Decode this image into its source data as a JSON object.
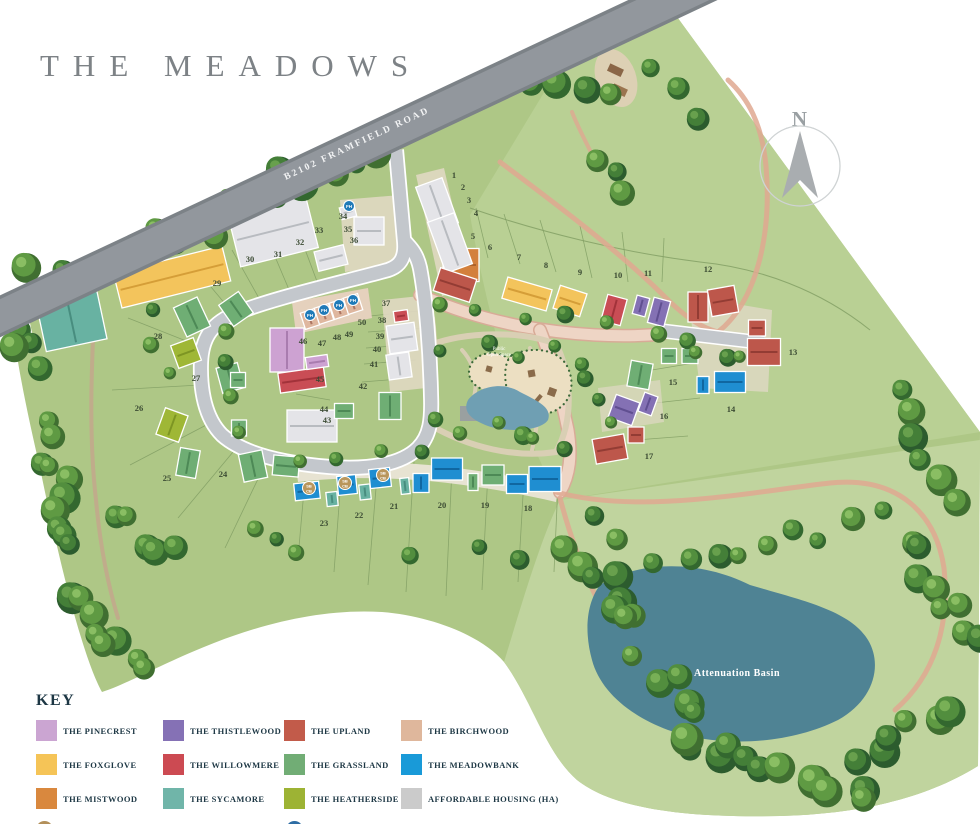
{
  "title": "THE MEADOWS",
  "road_label": "B2102 FRAMFIELD ROAD",
  "compass": {
    "label": "N"
  },
  "park_label": {
    "line1": "Public",
    "line2": "Open Space"
  },
  "basin_label": "Attenuation Basin",
  "key": {
    "heading": "KEY",
    "items": [
      {
        "name": "THE PINECREST",
        "slug": "pinecrest",
        "color": "#cba5d2"
      },
      {
        "name": "THE FOXGLOVE",
        "slug": "foxglove",
        "color": "#f5c457"
      },
      {
        "name": "THE MISTWOOD",
        "slug": "mistwood",
        "color": "#d9883e"
      },
      {
        "name": "THE THISTLEWOOD",
        "slug": "thistlewood",
        "color": "#8571b5"
      },
      {
        "name": "THE WILLOWMERE",
        "slug": "willowmere",
        "color": "#cc4a52"
      },
      {
        "name": "THE SYCAMORE",
        "slug": "sycamore",
        "color": "#70b5a9"
      },
      {
        "name": "THE UPLAND",
        "slug": "upland",
        "color": "#c25b4a"
      },
      {
        "name": "THE GRASSLAND",
        "slug": "grassland",
        "color": "#71ad75"
      },
      {
        "name": "THE HEATHERSIDE",
        "slug": "heatherside",
        "color": "#9db334"
      },
      {
        "name": "THE BIRCHWOOD",
        "slug": "birchwood",
        "color": "#dfb79c"
      },
      {
        "name": "THE MEADOWBANK",
        "slug": "meadowbank",
        "color": "#199ad8"
      },
      {
        "name": "AFFORDABLE HOUSING (HA)",
        "slug": "ha",
        "color": "#cbcbcb"
      }
    ],
    "notes": [
      {
        "badge_lines": [
          "SB",
          "CB"
        ],
        "badge_color": "#b3905a",
        "text": "PLOTS 21-23 ARE SELF-BUILD/CUSTOM-BUILD PLOTS"
      },
      {
        "badge_lines": [
          "FH"
        ],
        "badge_color": "#2e6da4",
        "text": "PLOTS 34, 47, 48, 49 & 50 ARE FIRST HOMES"
      }
    ]
  },
  "house_colors": {
    "pinecrest": {
      "fill": "#cda2d2",
      "dark": "#a678ac"
    },
    "foxglove": {
      "fill": "#f3c45c",
      "dark": "#d29a35"
    },
    "mistwood": {
      "fill": "#d3803c",
      "dark": "#a95f28"
    },
    "thistlewood": {
      "fill": "#8471b4",
      "dark": "#5d4c8e"
    },
    "willowmere": {
      "fill": "#c94d55",
      "dark": "#9e3038"
    },
    "sycamore": {
      "fill": "#68b2a2",
      "dark": "#458a7c"
    },
    "upland": {
      "fill": "#bd574b",
      "dark": "#8f3a32"
    },
    "grassland": {
      "fill": "#6fae74",
      "dark": "#4a8553"
    },
    "heatherside": {
      "fill": "#9fb736",
      "dark": "#7a9222"
    },
    "birchwood": {
      "fill": "#dfb79f",
      "dark": "#a9705c"
    },
    "meadowbank": {
      "fill": "#1f8ed1",
      "dark": "#0f639c"
    },
    "ha": {
      "fill": "#e4e4e8",
      "dark": "#b4b7bc"
    }
  },
  "plots": [
    {
      "n": "1",
      "x": 454,
      "y": 178
    },
    {
      "n": "2",
      "x": 463,
      "y": 190
    },
    {
      "n": "3",
      "x": 469,
      "y": 203
    },
    {
      "n": "4",
      "x": 476,
      "y": 216
    },
    {
      "n": "5",
      "x": 473,
      "y": 239
    },
    {
      "n": "6",
      "x": 490,
      "y": 250
    },
    {
      "n": "7",
      "x": 519,
      "y": 260
    },
    {
      "n": "8",
      "x": 546,
      "y": 268
    },
    {
      "n": "9",
      "x": 580,
      "y": 275
    },
    {
      "n": "10",
      "x": 618,
      "y": 278
    },
    {
      "n": "11",
      "x": 648,
      "y": 276
    },
    {
      "n": "12",
      "x": 708,
      "y": 272
    },
    {
      "n": "13",
      "x": 793,
      "y": 355
    },
    {
      "n": "14",
      "x": 731,
      "y": 412
    },
    {
      "n": "15",
      "x": 673,
      "y": 385
    },
    {
      "n": "16",
      "x": 664,
      "y": 419
    },
    {
      "n": "17",
      "x": 649,
      "y": 459
    },
    {
      "n": "18",
      "x": 528,
      "y": 511
    },
    {
      "n": "19",
      "x": 485,
      "y": 508
    },
    {
      "n": "20",
      "x": 442,
      "y": 508
    },
    {
      "n": "21",
      "x": 394,
      "y": 509
    },
    {
      "n": "22",
      "x": 359,
      "y": 518
    },
    {
      "n": "23",
      "x": 324,
      "y": 526
    },
    {
      "n": "24",
      "x": 223,
      "y": 477
    },
    {
      "n": "25",
      "x": 167,
      "y": 481
    },
    {
      "n": "26",
      "x": 139,
      "y": 411
    },
    {
      "n": "27",
      "x": 196,
      "y": 381
    },
    {
      "n": "28",
      "x": 158,
      "y": 339
    },
    {
      "n": "29",
      "x": 217,
      "y": 286
    },
    {
      "n": "30",
      "x": 250,
      "y": 262
    },
    {
      "n": "31",
      "x": 278,
      "y": 257
    },
    {
      "n": "32",
      "x": 300,
      "y": 245
    },
    {
      "n": "33",
      "x": 319,
      "y": 233
    },
    {
      "n": "34",
      "x": 343,
      "y": 219
    },
    {
      "n": "35",
      "x": 348,
      "y": 232
    },
    {
      "n": "36",
      "x": 354,
      "y": 243
    },
    {
      "n": "37",
      "x": 386,
      "y": 306
    },
    {
      "n": "38",
      "x": 382,
      "y": 323
    },
    {
      "n": "39",
      "x": 380,
      "y": 339
    },
    {
      "n": "40",
      "x": 377,
      "y": 352
    },
    {
      "n": "41",
      "x": 374,
      "y": 367
    },
    {
      "n": "42",
      "x": 363,
      "y": 389
    },
    {
      "n": "43",
      "x": 327,
      "y": 423
    },
    {
      "n": "44",
      "x": 324,
      "y": 412
    },
    {
      "n": "45",
      "x": 320,
      "y": 382
    },
    {
      "n": "46",
      "x": 303,
      "y": 344
    },
    {
      "n": "47",
      "x": 322,
      "y": 346
    },
    {
      "n": "48",
      "x": 337,
      "y": 340
    },
    {
      "n": "49",
      "x": 349,
      "y": 337
    },
    {
      "n": "50",
      "x": 362,
      "y": 325
    }
  ],
  "houses": [
    {
      "t": "sycamore",
      "x": 69,
      "y": 309,
      "w": 62,
      "h": 74,
      "r": -12
    },
    {
      "t": "sycamore",
      "x": 16,
      "y": 318,
      "w": 24,
      "h": 40,
      "r": -12
    },
    {
      "t": "foxglove",
      "x": 172,
      "y": 277,
      "w": 112,
      "h": 36,
      "r": -14
    },
    {
      "t": "ha",
      "x": 273,
      "y": 231,
      "w": 80,
      "h": 54,
      "r": -14
    },
    {
      "t": "ha",
      "x": 369,
      "y": 231,
      "w": 30,
      "h": 28,
      "r": 0
    },
    {
      "t": "ha",
      "x": 331,
      "y": 258,
      "w": 30,
      "h": 20,
      "r": -14
    },
    {
      "t": "ha",
      "x": 348,
      "y": 212,
      "w": 15,
      "h": 12,
      "r": -14
    },
    {
      "t": "pinecrest",
      "x": 287,
      "y": 350,
      "w": 34,
      "h": 44,
      "r": 0
    },
    {
      "t": "birchwood",
      "x": 310,
      "y": 319,
      "w": 15,
      "h": 17,
      "r": -18
    },
    {
      "t": "birchwood",
      "x": 324,
      "y": 314,
      "w": 15,
      "h": 17,
      "r": -18
    },
    {
      "t": "birchwood",
      "x": 339,
      "y": 309,
      "w": 15,
      "h": 17,
      "r": -18
    },
    {
      "t": "birchwood",
      "x": 353,
      "y": 304,
      "w": 15,
      "h": 17,
      "r": -18
    },
    {
      "t": "willowmere",
      "x": 302,
      "y": 380,
      "w": 46,
      "h": 20,
      "r": -8
    },
    {
      "t": "pinecrest",
      "x": 317,
      "y": 362,
      "w": 22,
      "h": 12,
      "r": -8
    },
    {
      "t": "ha",
      "x": 312,
      "y": 426,
      "w": 50,
      "h": 32,
      "r": 0
    },
    {
      "t": "grassland",
      "x": 192,
      "y": 317,
      "w": 26,
      "h": 32,
      "r": -25
    },
    {
      "t": "heatherside",
      "x": 186,
      "y": 353,
      "w": 24,
      "h": 24,
      "r": -20
    },
    {
      "t": "grassland",
      "x": 236,
      "y": 309,
      "w": 24,
      "h": 26,
      "r": -35
    },
    {
      "t": "grassland",
      "x": 230,
      "y": 378,
      "w": 22,
      "h": 26,
      "r": -15
    },
    {
      "t": "heatherside",
      "x": 172,
      "y": 425,
      "w": 24,
      "h": 28,
      "r": 20
    },
    {
      "t": "grassland",
      "x": 188,
      "y": 463,
      "w": 20,
      "h": 28,
      "r": 10
    },
    {
      "t": "grassland",
      "x": 253,
      "y": 466,
      "w": 24,
      "h": 28,
      "r": -12
    },
    {
      "t": "grassland",
      "x": 238,
      "y": 380,
      "w": 15,
      "h": 15,
      "r": 0
    },
    {
      "t": "grassland",
      "x": 239,
      "y": 428,
      "w": 15,
      "h": 16,
      "r": 0
    },
    {
      "t": "grassland",
      "x": 286,
      "y": 466,
      "w": 26,
      "h": 20,
      "r": 5
    },
    {
      "t": "mistwood",
      "x": 461,
      "y": 265,
      "w": 36,
      "h": 33,
      "r": 0
    },
    {
      "t": "ha",
      "x": 437,
      "y": 205,
      "w": 28,
      "h": 48,
      "r": -20
    },
    {
      "t": "ha",
      "x": 450,
      "y": 243,
      "w": 28,
      "h": 54,
      "r": -20
    },
    {
      "t": "upland",
      "x": 455,
      "y": 285,
      "w": 38,
      "h": 24,
      "r": 18
    },
    {
      "t": "foxglove",
      "x": 527,
      "y": 294,
      "w": 46,
      "h": 22,
      "r": 16
    },
    {
      "t": "foxglove",
      "x": 570,
      "y": 301,
      "w": 28,
      "h": 24,
      "r": 18
    },
    {
      "t": "willowmere",
      "x": 614,
      "y": 310,
      "w": 20,
      "h": 27,
      "r": 15
    },
    {
      "t": "thistlewood",
      "x": 641,
      "y": 306,
      "w": 13,
      "h": 19,
      "r": 15
    },
    {
      "t": "thistlewood",
      "x": 659,
      "y": 312,
      "w": 17,
      "h": 26,
      "r": 15
    },
    {
      "t": "grassland",
      "x": 669,
      "y": 356,
      "w": 15,
      "h": 15,
      "r": 0
    },
    {
      "t": "grassland",
      "x": 690,
      "y": 356,
      "w": 16,
      "h": 15,
      "r": 0
    },
    {
      "t": "grassland",
      "x": 640,
      "y": 375,
      "w": 22,
      "h": 26,
      "r": 10
    },
    {
      "t": "thistlewood",
      "x": 624,
      "y": 410,
      "w": 25,
      "h": 24,
      "r": 20
    },
    {
      "t": "thistlewood",
      "x": 648,
      "y": 404,
      "w": 14,
      "h": 20,
      "r": 20
    },
    {
      "t": "upland",
      "x": 636,
      "y": 435,
      "w": 16,
      "h": 16,
      "r": 0
    },
    {
      "t": "upland",
      "x": 610,
      "y": 449,
      "w": 32,
      "h": 25,
      "r": -10
    },
    {
      "t": "upland",
      "x": 698,
      "y": 307,
      "w": 20,
      "h": 30,
      "r": 0
    },
    {
      "t": "upland",
      "x": 723,
      "y": 301,
      "w": 27,
      "h": 27,
      "r": -10
    },
    {
      "t": "upland",
      "x": 757,
      "y": 328,
      "w": 17,
      "h": 16,
      "r": 0
    },
    {
      "t": "upland",
      "x": 764,
      "y": 352,
      "w": 33,
      "h": 27,
      "r": 0
    },
    {
      "t": "meadowbank",
      "x": 730,
      "y": 382,
      "w": 31,
      "h": 21,
      "r": 0
    },
    {
      "t": "meadowbank",
      "x": 703,
      "y": 385,
      "w": 12,
      "h": 17,
      "r": 0
    },
    {
      "t": "willowmere",
      "x": 401,
      "y": 316,
      "w": 14,
      "h": 11,
      "r": -8
    },
    {
      "t": "ha",
      "x": 402,
      "y": 338,
      "w": 28,
      "h": 28,
      "r": -8
    },
    {
      "t": "ha",
      "x": 399,
      "y": 366,
      "w": 23,
      "h": 25,
      "r": -8
    },
    {
      "t": "grassland",
      "x": 390,
      "y": 406,
      "w": 22,
      "h": 27,
      "r": 0
    },
    {
      "t": "grassland",
      "x": 344,
      "y": 411,
      "w": 19,
      "h": 15,
      "r": 0
    },
    {
      "t": "meadowbank",
      "x": 307,
      "y": 491,
      "w": 25,
      "h": 17,
      "r": -6
    },
    {
      "t": "sycamore",
      "x": 332,
      "y": 499,
      "w": 11,
      "h": 14,
      "r": -6
    },
    {
      "t": "meadowbank",
      "x": 347,
      "y": 485,
      "w": 19,
      "h": 19,
      "r": -6
    },
    {
      "t": "sycamore",
      "x": 365,
      "y": 492,
      "w": 11,
      "h": 15,
      "r": -6
    },
    {
      "t": "meadowbank",
      "x": 380,
      "y": 478,
      "w": 21,
      "h": 19,
      "r": -6
    },
    {
      "t": "sycamore",
      "x": 405,
      "y": 486,
      "w": 9,
      "h": 16,
      "r": -6
    },
    {
      "t": "meadowbank",
      "x": 421,
      "y": 483,
      "w": 16,
      "h": 19,
      "r": 0
    },
    {
      "t": "meadowbank",
      "x": 447,
      "y": 469,
      "w": 31,
      "h": 22,
      "r": 0
    },
    {
      "t": "grassland",
      "x": 473,
      "y": 482,
      "w": 10,
      "h": 17,
      "r": 0
    },
    {
      "t": "grassland",
      "x": 493,
      "y": 475,
      "w": 22,
      "h": 20,
      "r": 0
    },
    {
      "t": "meadowbank",
      "x": 517,
      "y": 484,
      "w": 21,
      "h": 19,
      "r": 0
    },
    {
      "t": "meadowbank",
      "x": 545,
      "y": 479,
      "w": 32,
      "h": 25,
      "r": 0
    }
  ],
  "map_badges": {
    "fh": {
      "label": "FH",
      "color": "#1f7ab8",
      "positions": [
        {
          "x": 349,
          "y": 206
        },
        {
          "x": 310,
          "y": 315
        },
        {
          "x": 324,
          "y": 310
        },
        {
          "x": 339,
          "y": 305
        },
        {
          "x": 353,
          "y": 300
        }
      ]
    },
    "sb": {
      "lines": [
        "SB",
        "CB"
      ],
      "color": "#b9965c",
      "positions": [
        {
          "x": 309,
          "y": 488
        },
        {
          "x": 345,
          "y": 483
        },
        {
          "x": 383,
          "y": 475
        }
      ]
    }
  }
}
